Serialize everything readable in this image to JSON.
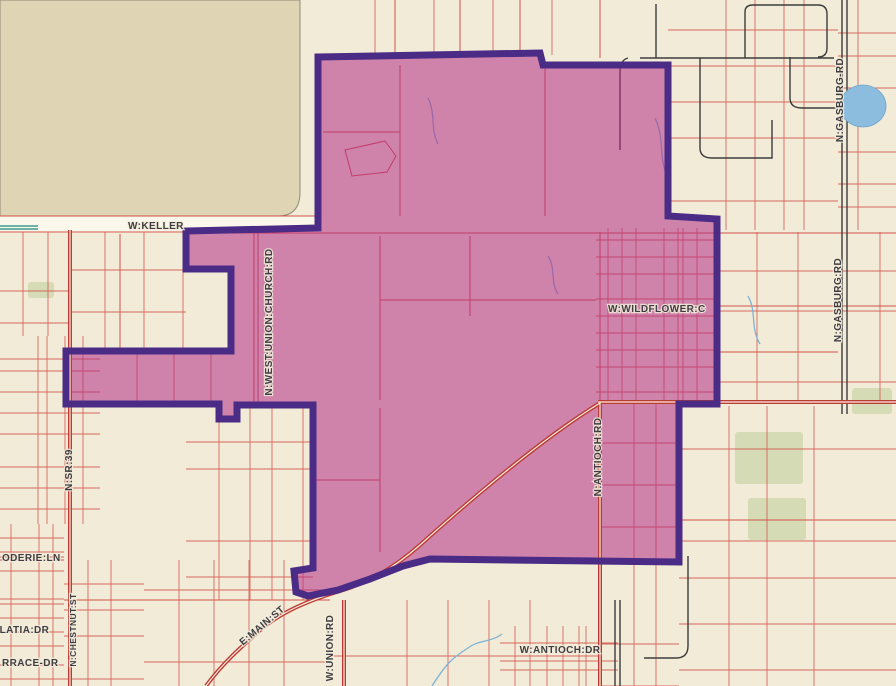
{
  "map": {
    "kind": "county-parcel-map-with-highlighted-district",
    "width": 896,
    "height": 686,
    "colors": {
      "background": "#F1EBD7",
      "tan_block": "#DFD4B3",
      "tan_border": "#8F8C74",
      "white_road": "#FAF7EB",
      "parcel_red": "#D4514B",
      "major_road_red": "#BE3A34",
      "road_center": "#F6EFDD",
      "dark_road": "#3C3C3C",
      "water_blue": "#8CBCDE",
      "stream_blue": "#7FB3D6",
      "green_patch": "#CBD6A8",
      "teal_mark": "#3C9B8F",
      "district_fill": "#B22C85",
      "district_fill_opacity": 0.55,
      "district_stroke": "#4A2B85",
      "label_text": "#3F3D42"
    },
    "district_boundary": {
      "points": "318,57 540,53 543,65 668,65 668,216 717,219 717,404 679,404 679,562 430,559 403,566 370,579 338,590 308,596 296,592 294,571 313,568 313,405 237,405 237,419 219,419 219,404 66,404 66,351 231,351 231,269 186,269 186,231 318,228",
      "stroke_width": 7
    },
    "labels": [
      {
        "text": "W:KELLER",
        "x": 128,
        "y": 229,
        "rot": 0,
        "size": 10,
        "anchor": "start"
      },
      {
        "text": "N:WEST:UNION:CHURCH:RD",
        "x": 272,
        "y": 322,
        "rot": -90,
        "size": 10,
        "anchor": "middle"
      },
      {
        "text": "W:WILDFLOWER:C",
        "x": 608,
        "y": 312,
        "rot": 0,
        "size": 10,
        "anchor": "start"
      },
      {
        "text": "N:ANTIOCH:RD",
        "x": 601,
        "y": 457,
        "rot": -90,
        "size": 10,
        "anchor": "middle"
      },
      {
        "text": "N:GASBURG-RD",
        "x": 843,
        "y": 100,
        "rot": -90,
        "size": 10,
        "anchor": "middle"
      },
      {
        "text": "N:GASBURG:RD",
        "x": 841,
        "y": 300,
        "rot": -90,
        "size": 10,
        "anchor": "middle"
      },
      {
        "text": "N:SR:39",
        "x": 72,
        "y": 470,
        "rot": -90,
        "size": 10,
        "anchor": "middle"
      },
      {
        "text": "ODERIE:LN",
        "x": 2,
        "y": 561,
        "rot": 0,
        "size": 10,
        "anchor": "start"
      },
      {
        "text": "ALATIA:DR",
        "x": -8,
        "y": 633,
        "rot": 0,
        "size": 10,
        "anchor": "start"
      },
      {
        "text": "RRACE-DR",
        "x": 2,
        "y": 666,
        "rot": 0,
        "size": 10,
        "anchor": "start"
      },
      {
        "text": "N:CHESTNUT:ST",
        "x": 76,
        "y": 630,
        "rot": -90,
        "size": 8.5,
        "anchor": "middle"
      },
      {
        "text": "E:MAIN:ST",
        "x": 264,
        "y": 628,
        "rot": -40,
        "size": 10,
        "anchor": "middle"
      },
      {
        "text": "W:UNION:RD",
        "x": 333,
        "y": 648,
        "rot": -90,
        "size": 10,
        "anchor": "middle"
      },
      {
        "text": "W:ANTIOCH:DR",
        "x": 560,
        "y": 653,
        "rot": 0,
        "size": 10,
        "anchor": "middle"
      }
    ],
    "tan_block_path": "M0,0 H300 V192 Q300,216 278,216 H0 Z",
    "white_road": {
      "x": 0,
      "y": 216,
      "w": 322,
      "h": 17
    },
    "grid_regions": [
      {
        "x": 320,
        "y": 0,
        "w": 348,
        "h": 55,
        "sx": 58,
        "sy": 0
      },
      {
        "x": 668,
        "y": 0,
        "w": 170,
        "h": 230,
        "sx": 28,
        "sy": 34
      },
      {
        "x": 838,
        "y": 0,
        "w": 58,
        "h": 230,
        "sx": 24,
        "sy": 30
      },
      {
        "x": 717,
        "y": 232,
        "w": 179,
        "h": 170,
        "sx": 40,
        "sy": 38
      },
      {
        "x": 679,
        "y": 406,
        "w": 217,
        "h": 280,
        "sx": 46,
        "sy": 44
      },
      {
        "x": 0,
        "y": 232,
        "w": 70,
        "h": 104,
        "sx": 24,
        "sy": 30
      },
      {
        "x": 0,
        "y": 336,
        "w": 100,
        "h": 188,
        "sx": 17,
        "sy": 19
      },
      {
        "x": 0,
        "y": 524,
        "w": 64,
        "h": 162,
        "sx": 13,
        "sy": 12
      },
      {
        "x": 64,
        "y": 560,
        "w": 80,
        "h": 126,
        "sx": 22,
        "sy": 24
      },
      {
        "x": 70,
        "y": 232,
        "w": 116,
        "h": 120,
        "sx": 38,
        "sy": 40
      },
      {
        "x": 144,
        "y": 560,
        "w": 186,
        "h": 126,
        "sx": 34,
        "sy": 34
      },
      {
        "x": 330,
        "y": 600,
        "w": 270,
        "h": 86,
        "sx": 40,
        "sy": 30
      },
      {
        "x": 500,
        "y": 626,
        "w": 118,
        "h": 60,
        "sx": 15,
        "sy": 16
      },
      {
        "x": 600,
        "y": 404,
        "w": 79,
        "h": 282,
        "sx": 30,
        "sy": 40
      },
      {
        "x": 596,
        "y": 228,
        "w": 121,
        "h": 174,
        "sx": 13,
        "sy": 15
      },
      {
        "x": 186,
        "y": 404,
        "w": 127,
        "h": 196,
        "sx": 30,
        "sy": 34
      },
      {
        "x": 66,
        "y": 352,
        "w": 165,
        "h": 52,
        "sx": 36,
        "sy": 0
      }
    ],
    "red_lines": [
      "M395,0 V55",
      "M460,0 V55",
      "M520,0 V54",
      "M600,0 V58",
      "M400,65 V216",
      "M545,68 V216",
      "M323,132 H400",
      "M345,150 L385,141 L396,156 L387,172 L352,176 Z",
      "M254,232 V404",
      "M258,232 V404",
      "M380,236 V400",
      "M470,236 V316",
      "M380,300 H596",
      "M186,233 H896",
      "M600,232 V404",
      "M120,234 V350",
      "M380,408 V552",
      "M313,480 H380",
      "M0,560 H64",
      "M64,600 H330",
      "M717,306 H896",
      "M717,352 H838",
      "M679,520 H896",
      "M0,216 H318",
      "M0,232 H186"
    ],
    "teal_lines": [
      "M0,226 H38",
      "M0,229 H38"
    ],
    "major_roads": [
      "M70,230 V686",
      "M600,402 V686",
      "M598,402 H896",
      "M600,403 C540,440 470,500 420,545 C395,567 370,582 340,591 C310,600 280,612 258,632 C240,648 222,664 206,686",
      "M344,600 V686"
    ],
    "dark_roads": [
      "M656,4 V58",
      "M640,58 H834",
      "M628,58 Q620,60 620,72 V150",
      "M700,58 V148 Q700,158 712,158 H772 V120",
      "M745,58 V12 Q745,5 753,5 H818 Q827,5 827,14 V48 Q827,57 818,57",
      "M790,57 V98 Q790,108 802,108 H838",
      "M688,556 V646 Q688,658 676,658 H644",
      "M842,0 V414",
      "M847,0 V414",
      "M615,600 V686",
      "M620,600 V686"
    ],
    "water": {
      "pond": {
        "cx": 863,
        "cy": 106,
        "rx": 23,
        "ry": 21
      },
      "streams": [
        "M432,686 C446,664 452,658 468,648 C478,640 492,642 502,634",
        "M428,98 C436,114 430,128 438,144",
        "M548,256 C556,268 550,282 558,294",
        "M655,118 C665,138 658,158 668,178",
        "M748,296 C757,312 750,328 760,344"
      ]
    },
    "green_patches": [
      {
        "x": 735,
        "y": 432,
        "w": 68,
        "h": 52
      },
      {
        "x": 748,
        "y": 498,
        "w": 58,
        "h": 42
      },
      {
        "x": 28,
        "y": 282,
        "w": 26,
        "h": 16
      },
      {
        "x": 852,
        "y": 388,
        "w": 40,
        "h": 26
      }
    ]
  }
}
